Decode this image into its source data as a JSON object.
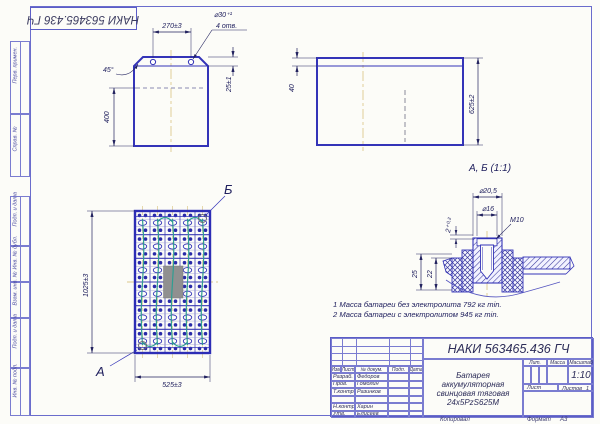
{
  "document": {
    "number": "НАКИ 563465.436 ГЧ",
    "copy_label": "Копировал",
    "format_label": "Формат",
    "format": "А3"
  },
  "margin_boxes": [
    {
      "label": "Перв. примен."
    },
    {
      "label": "Справ. №"
    },
    {
      "label": "Подп. и дата"
    },
    {
      "label": "Инв. № дубл."
    },
    {
      "label": "Взам. инв. №"
    },
    {
      "label": "Подп. и дата"
    },
    {
      "label": "Инв. № подл."
    }
  ],
  "views": {
    "front": {
      "dim_holes_span": "270±3",
      "dim_hole_dia": "⌀30⁺¹",
      "dim_hole_count": "4 отв.",
      "dim_chamfer": "45°",
      "dim_top_offset": "25±1",
      "dim_level": "400"
    },
    "side": {
      "dim_lip": "40",
      "dim_height": "625±2"
    },
    "top": {
      "label_a": "А",
      "label_b": "Б",
      "dim_width": "525±3",
      "dim_height": "1025±3"
    },
    "detail": {
      "title": "А, Б (1:1)",
      "dim_d1": "⌀20,5",
      "dim_d2": "⌀16",
      "dim_thread": "М10",
      "dim_step": "2⁺⁰·²",
      "dim_h1": "25",
      "dim_h2": "22"
    }
  },
  "notes": {
    "line1": "1 Масса батареи без электролита 792 кг min.",
    "line2": "2 Масса батареи с электролитом 945 кг min."
  },
  "title_block": {
    "number": "НАКИ 563465.436 ГЧ",
    "header": {
      "izm": "Изм",
      "list": "Лист",
      "doc": "№ докум.",
      "sign": "Подп.",
      "date": "Дата"
    },
    "rows": [
      {
        "role": "Разраб.",
        "name": "Федоров"
      },
      {
        "role": "Пров.",
        "name": "Гомолин"
      },
      {
        "role": "Т.контр.",
        "name": "Разинков"
      },
      {
        "role": "",
        "name": ""
      },
      {
        "role": "Н.контр.",
        "name": "Харин"
      },
      {
        "role": "Утв.",
        "name": "Елисеев"
      }
    ],
    "product": {
      "line1": "Батарея аккумуляторная",
      "line2": "свинцовая тяговая",
      "line3": "24x5PzS625M"
    },
    "labels": {
      "lit": "Лит.",
      "mass": "Масса",
      "scale": "Масштаб",
      "sheet": "Лист",
      "sheets": "Листов"
    },
    "values": {
      "scale": "1:10",
      "sheets_count": "1"
    }
  },
  "grid": {
    "cols": 5,
    "groups": 6
  }
}
